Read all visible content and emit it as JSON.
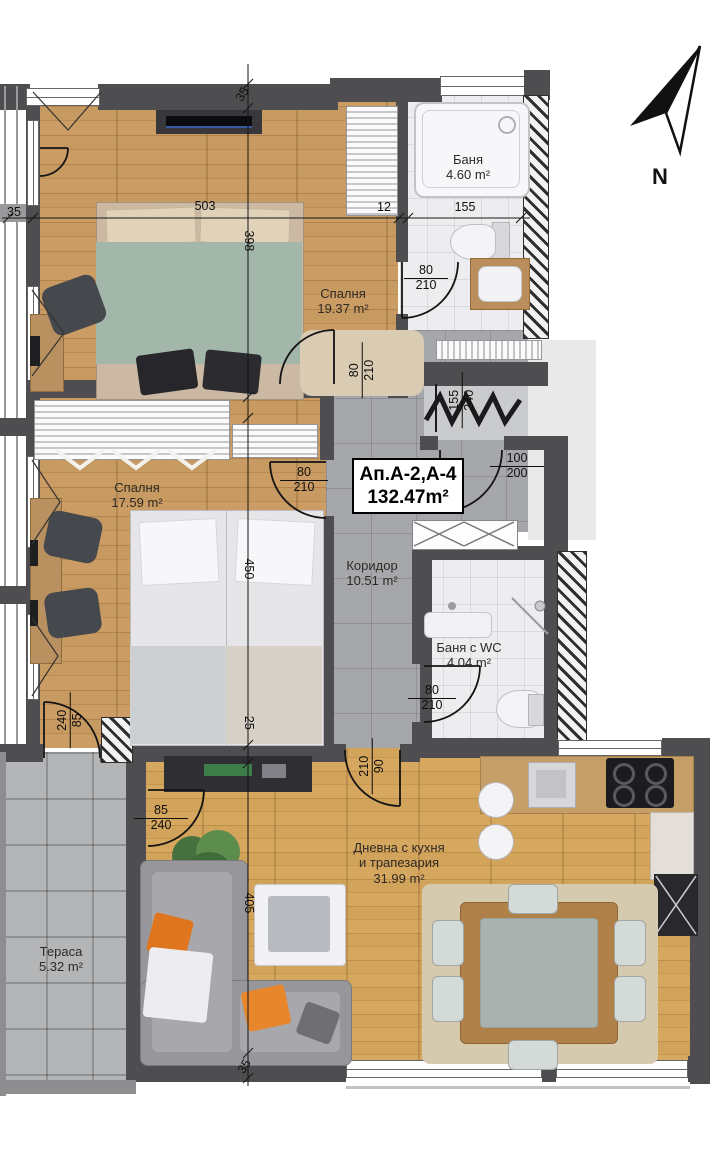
{
  "unit": {
    "name": "Ап.А-2,А-4",
    "area": "132.47m²"
  },
  "north": "N",
  "rooms": {
    "bath": {
      "name": "Баня",
      "area": "4.60 m²"
    },
    "bedroom1": {
      "name": "Спалня",
      "area": "19.37 m²"
    },
    "bedroom2": {
      "name": "Спалня",
      "area": "17.59 m²"
    },
    "corridor": {
      "name": "Коридор",
      "area": "10.51 m²"
    },
    "bath_wc": {
      "name": "Баня с WC",
      "area": "4.04 m²"
    },
    "living": {
      "name_line1": "Дневна с кухня",
      "name_line2": "и трапезария",
      "area": "31.99 m²"
    },
    "terrace": {
      "name": "Тераса",
      "area": "5.32 m²"
    }
  },
  "dims": {
    "wall_top": "35",
    "wall_left": "35",
    "bed1_width": "503",
    "wall_12": "12",
    "bath_width": "155",
    "bed1_height": "398",
    "bed2_height": "450",
    "wall_25": "25",
    "living_height": "405",
    "wall_bottom": "35",
    "door_bath": {
      "w": "80",
      "h": "210"
    },
    "door_entry": {
      "w": "100",
      "h": "200"
    },
    "door_bed1": {
      "w": "80",
      "h": "210"
    },
    "door_bed2": {
      "w": "80",
      "h": "210"
    },
    "door_wc": {
      "w": "80",
      "h": "210"
    },
    "door_bed2_terrace": {
      "w": "240",
      "h": "85"
    },
    "door_living": {
      "w": "210",
      "h": "90"
    },
    "door_living_terrace": {
      "w": "85",
      "h": "240"
    },
    "shaft": {
      "w": "155",
      "h": "240"
    }
  }
}
